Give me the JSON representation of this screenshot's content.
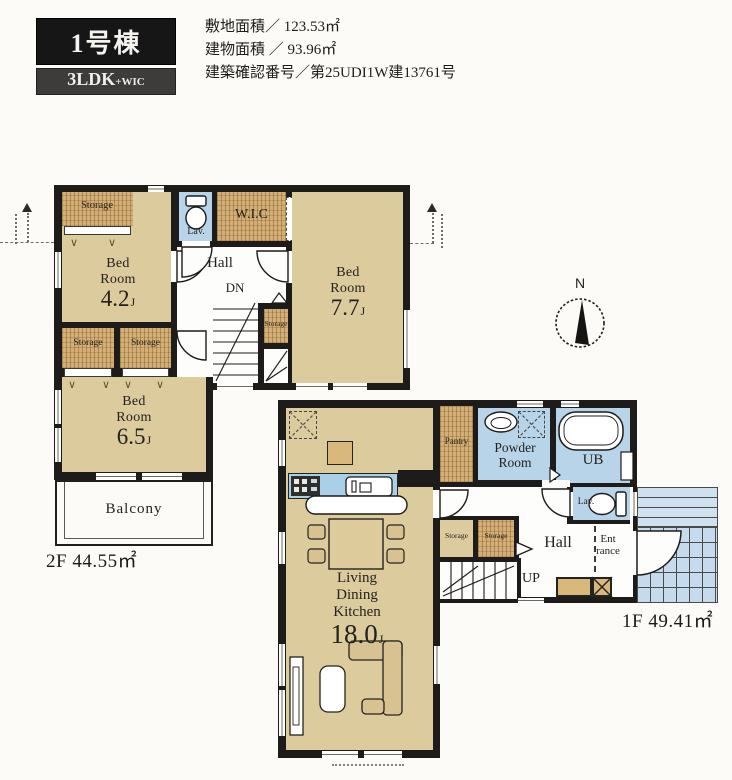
{
  "header": {
    "building_badge": "1号棟",
    "layout_badge": {
      "main": "3LDK",
      "suffix": "+WIC"
    },
    "info_lines": [
      {
        "label": "敷地面積",
        "separator": "／",
        "value": "123.53㎡"
      },
      {
        "label": "建物面積",
        "separator": "／",
        "value": "93.96㎡"
      },
      {
        "label": "建築確認番号",
        "separator": "／",
        "value": "第25UDI1W建13761号"
      }
    ]
  },
  "compass": {
    "north_label": "N"
  },
  "floor_2f": {
    "area_caption": "2F 44.55㎡",
    "bedroom_1": {
      "name_line1": "Bed",
      "name_line2": "Room",
      "size": "4.2",
      "size_unit": "J"
    },
    "bedroom_2": {
      "name_line1": "Bed",
      "name_line2": "Room",
      "size": "7.7",
      "size_unit": "J"
    },
    "bedroom_3": {
      "name_line1": "Bed",
      "name_line2": "Room",
      "size": "6.5",
      "size_unit": "J"
    },
    "hall": "Hall",
    "stairs_down": "DN",
    "lavatory": "Lav.",
    "wic": "W.I.C",
    "storage_top_left": "Storage",
    "storage_mid_left_1": "Storage",
    "storage_mid_left_2": "Storage",
    "storage_under_stairs": "Storage",
    "balcony": "Balcony"
  },
  "floor_1f": {
    "area_caption": "1F 49.41㎡",
    "ldk": {
      "name_line1": "Living",
      "name_line2": "Dining",
      "name_line3": "Kitchen",
      "size": "18.0",
      "size_unit": "J"
    },
    "pantry": "Pantry",
    "powder_room": {
      "line1": "Powder",
      "line2": "Room"
    },
    "unit_bath": "UB",
    "lavatory": "Lav.",
    "hall": "Hall",
    "entrance": {
      "line1": "Ent",
      "line2": "rance"
    },
    "storage_1": "Storage",
    "storage_2": "Storage",
    "stairs_up": "UP"
  }
}
